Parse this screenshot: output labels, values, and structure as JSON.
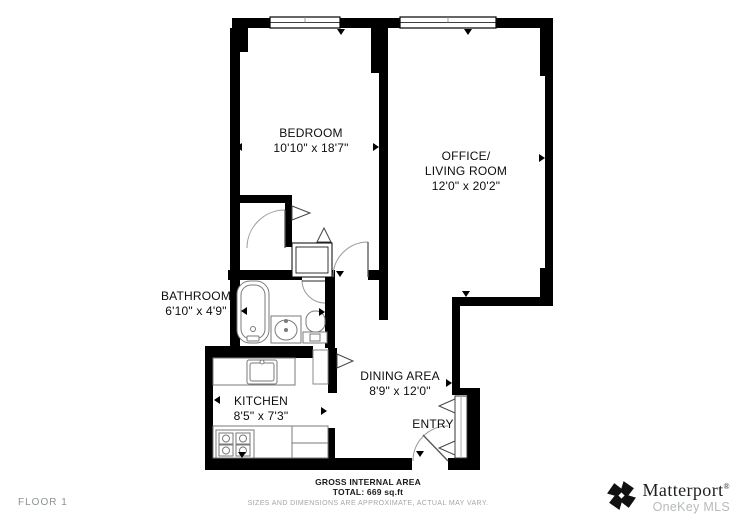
{
  "floor_label": "FLOOR 1",
  "rooms": [
    {
      "name": "BEDROOM",
      "dims": "10'10\" x 18'7\""
    },
    {
      "name": "OFFICE/\nLIVING ROOM",
      "dims": "12'0\" x 20'2\""
    },
    {
      "name": "BATHROOM",
      "dims": "6'10\" x 4'9\""
    },
    {
      "name": "KITCHEN",
      "dims": "8'5\" x 7'3\""
    },
    {
      "name": "DINING AREA",
      "dims": "8'9\" x 12'0\""
    },
    {
      "name": "ENTRY",
      "dims": ""
    }
  ],
  "footer": {
    "area_title": "GROSS INTERNAL AREA",
    "area_total": "TOTAL: 669 sq.ft",
    "disclaimer": "SIZES AND DIMENSIONS ARE APPROXIMATE, ACTUAL MAY VARY."
  },
  "branding": {
    "brand": "Matterport",
    "trademark": "®",
    "mls": "OneKey MLS",
    "logo_icon": "matterport-pinwheel-icon"
  },
  "colors": {
    "wall": "#000000",
    "fixture_stroke": "#7a7a7a",
    "door_arc": "#9a9a9a",
    "label_text": "#0d0d0d",
    "muted_text": "#8d9294",
    "brand_gray": "#b7babc"
  }
}
